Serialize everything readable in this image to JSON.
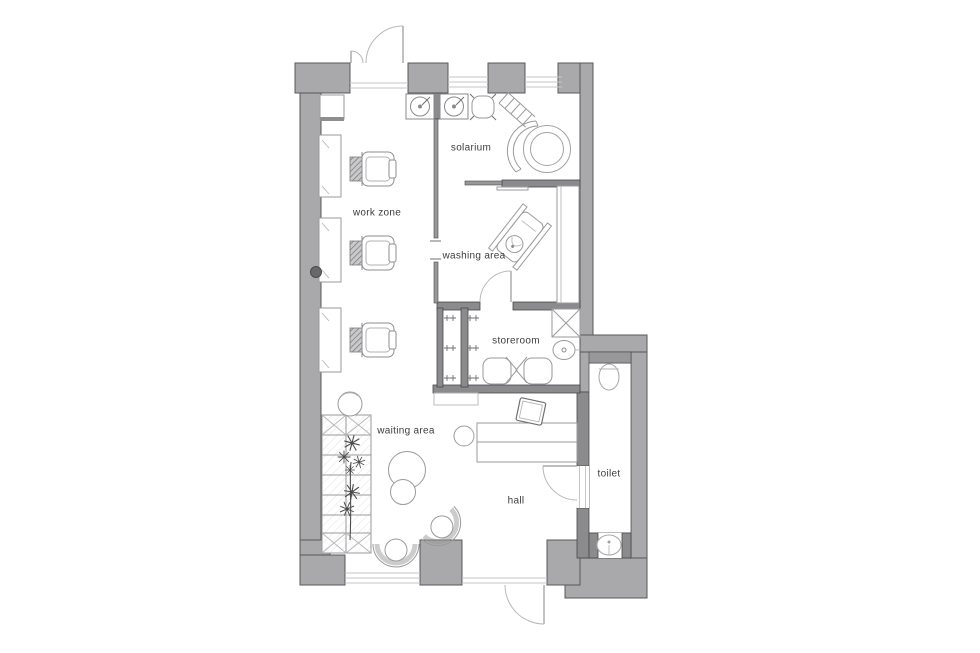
{
  "floor_plan": {
    "type": "salon-floor-plan",
    "rooms": [
      {
        "id": "work-zone",
        "label": "work zone"
      },
      {
        "id": "solarium",
        "label": "solarium"
      },
      {
        "id": "washing-area",
        "label": "washing area"
      },
      {
        "id": "storeroom",
        "label": "storeroom"
      },
      {
        "id": "waiting-area",
        "label": "waiting area"
      },
      {
        "id": "hall",
        "label": "hall"
      },
      {
        "id": "toilet",
        "label": "toilet"
      }
    ],
    "colors": {
      "wall_fill": "#a9a9ab",
      "wall_edge": "#58585a",
      "partition_fill": "#8b8b8d",
      "partition_edge": "#47474a",
      "floor": "#ffffff",
      "furniture_line": "#9a9a9c",
      "furniture_dark": "#707072",
      "window_line": "#c6c6c8",
      "door_arc": "#b8b8ba",
      "plant": "#4b4b4d",
      "label_text": "#3c3c3e"
    }
  }
}
